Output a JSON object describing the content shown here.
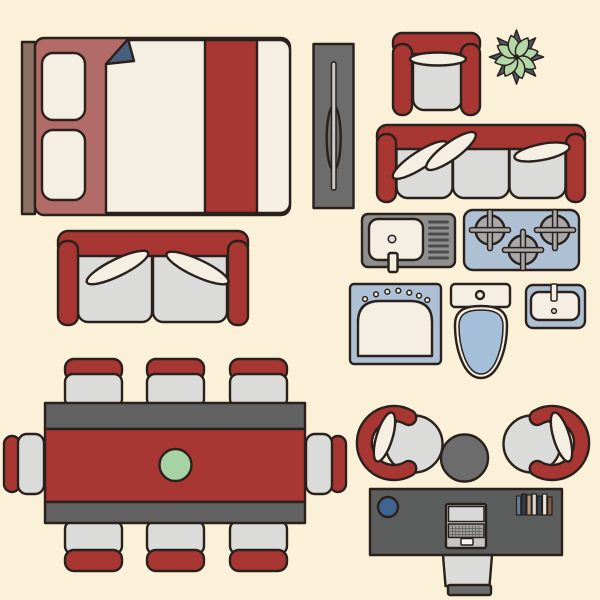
{
  "illustration_label": "furniture-top-view-flat-icon-set",
  "palette": {
    "bg": "#fbf1d8",
    "outline": "#2a211c",
    "red": "#a83733",
    "mauve": "#b26b66",
    "brown": "#8c7263",
    "cream": "#f4eee3",
    "lightgray": "#dbdbd9",
    "sinkgray": "#8f8f8f",
    "darkgray": "#6c6c6c",
    "deskgray": "#5c5d5d",
    "bandgray": "#626262",
    "bluegray": "#aec0d4",
    "toiletblue": "#a5bfd9",
    "foldslate": "#47617d",
    "starslate": "#4b5c6c",
    "leafgreen": "#b5d6a6",
    "plategreen": "#a6d2a4",
    "deskblue": "#3e6590",
    "burnergray": "#a9a9a9",
    "drainerdark": "#4c4c4c",
    "handlelight": "#cccccc",
    "laptopbody": "#c6c6c6",
    "laptopscreen": "#d8d8d8",
    "laptopkeys": "#a0a0a0",
    "trackpad": "#f5f5f5"
  },
  "items": {
    "bed": {
      "label": "double bed top view"
    },
    "wardrobe": {
      "label": "wardrobe panel top view"
    },
    "armchair": {
      "label": "armchair top view"
    },
    "plant": {
      "label": "succulent plant top view"
    },
    "sofa": {
      "label": "three seat sofa top view"
    },
    "loveseat": {
      "label": "two seat sofa top view"
    },
    "kitchen_sink": {
      "label": "kitchen sink with drainer top view"
    },
    "stove": {
      "label": "gas hob with three burners top view"
    },
    "vanity": {
      "label": "bathroom vanity basin top view"
    },
    "toilet": {
      "label": "toilet top view"
    },
    "bathroom_sink": {
      "label": "small washbasin top view"
    },
    "dining_table": {
      "label": "dining table with eight chairs top view"
    },
    "office": {
      "label": "office desk set top view",
      "books": [
        "#5d7e9b",
        "#303d4f",
        "#b49a79",
        "#d8d8d8",
        "#33445b",
        "#e9e4d9",
        "#7d5c41"
      ]
    }
  }
}
